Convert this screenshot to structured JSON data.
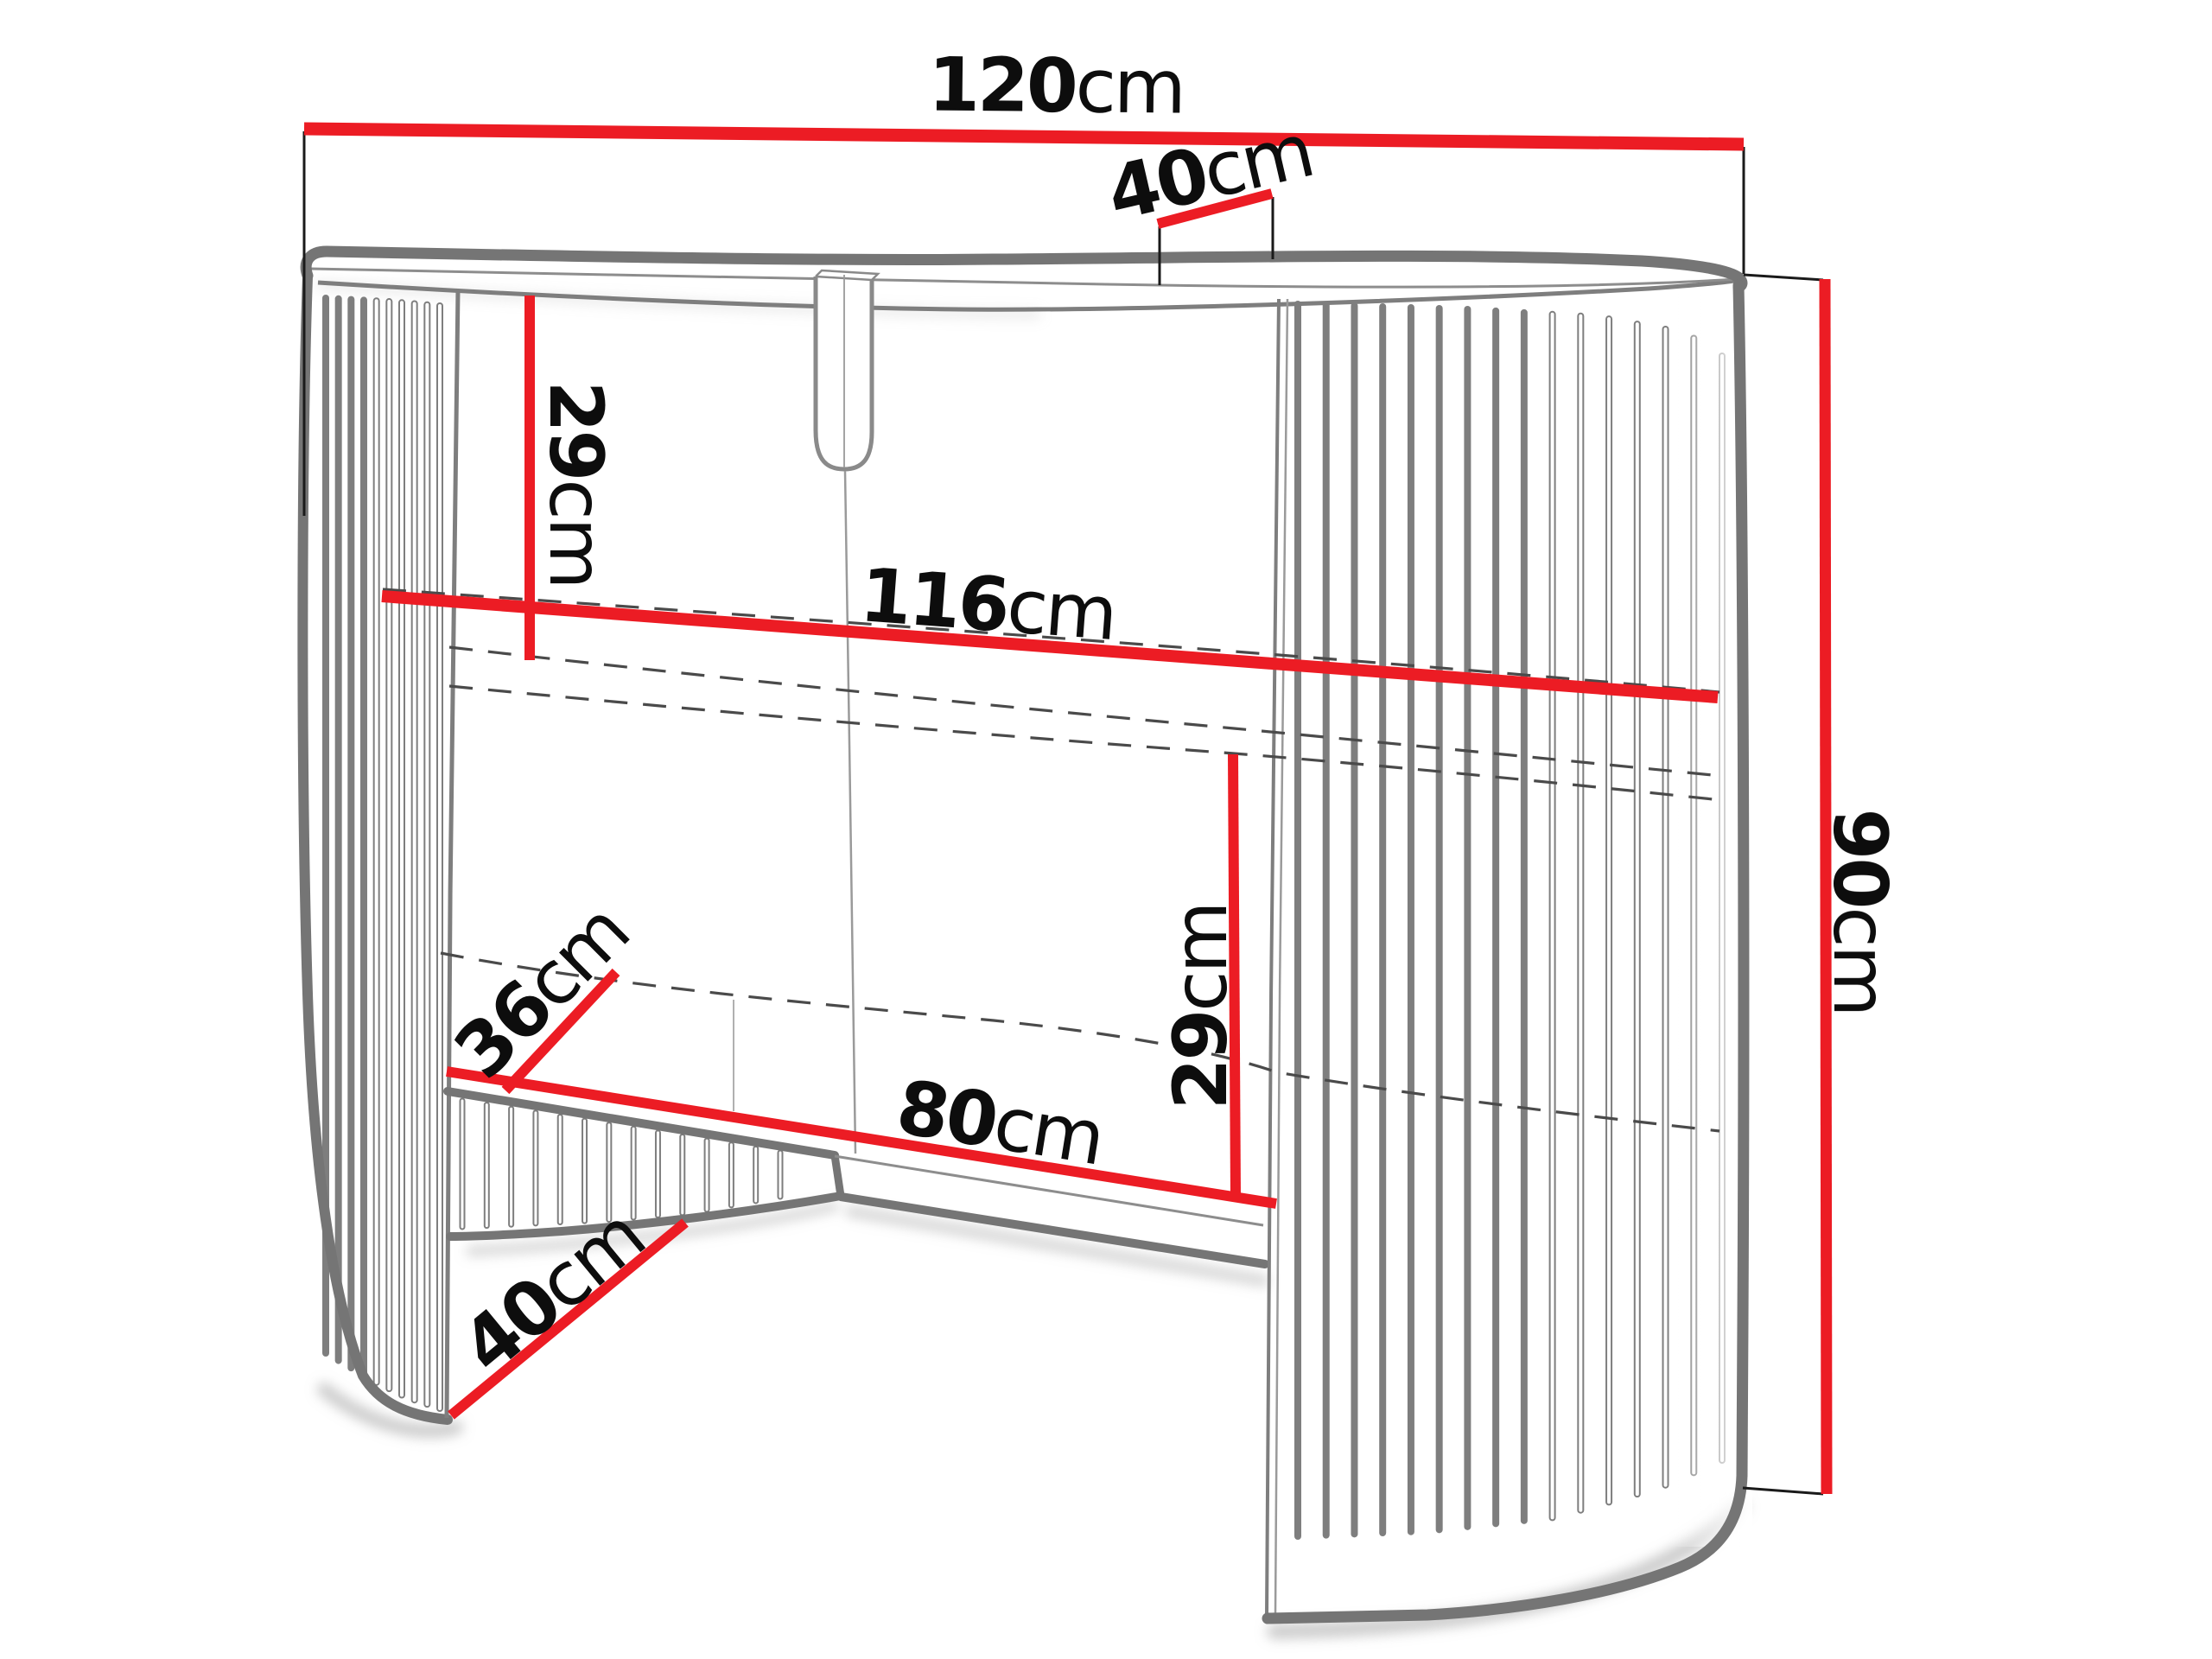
{
  "figure": {
    "type": "furniture-dimension-diagram",
    "subject": "curved slatted console dressing table, line drawing with red dimension lines"
  },
  "colors": {
    "dimension_red": "#ec1c24",
    "outline_gray": "#757575",
    "detail_gray": "#8d8d8d",
    "dash_gray": "#4a4a4a",
    "extension_black": "#1a1a1a",
    "label_black": "#0d0d0d",
    "background": "#ffffff"
  },
  "dims": {
    "total_width": {
      "value": "120",
      "unit": "cm"
    },
    "top_depth": {
      "value": "40",
      "unit": "cm"
    },
    "top_to_shelf": {
      "value": "29",
      "unit": "cm"
    },
    "inner_width": {
      "value": "116",
      "unit": "cm"
    },
    "base_depth": {
      "value": "36",
      "unit": "cm"
    },
    "shelf_to_base": {
      "value": "29",
      "unit": "cm"
    },
    "opening_width": {
      "value": "80",
      "unit": "cm"
    },
    "foot_depth": {
      "value": "40",
      "unit": "cm"
    },
    "total_height": {
      "value": "90",
      "unit": "cm"
    }
  }
}
